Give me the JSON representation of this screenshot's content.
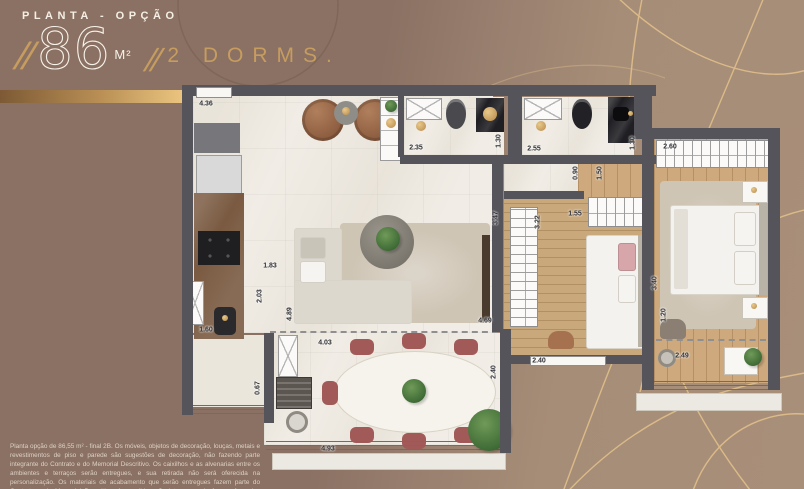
{
  "header": {
    "kicker": "PLANTA - OPÇÃO",
    "slash1": "//",
    "area_value": "86",
    "area_unit": "M²",
    "slash2": "//",
    "dorms": "2 DORMS."
  },
  "disclaimer": "Planta opção de 86,55 m² - final 2B. Os móveis, objetos de decoração, louças, metais e revestimentos de piso e parede são sugestões de decoração, não fazendo parte integrante do Contrato e do Memorial Descritivo. Os caixilhos e as alvenarias entre os ambientes e terraços serão entregues, e sua retirada não será oferecida na personalização. Os materiais de acabamento que serão entregues fazem parte do Contrato e do Memorial Descritivo. As medidas são internas e de face a face das paredes.",
  "plan": {
    "dims": {
      "living_top_width": "4.36",
      "bath1_width": "2.35",
      "bath1_depth": "1.30",
      "bath2_width": "2.55",
      "bath2_depth": "1.30",
      "suite_wardrobe_width": "2.60",
      "hall_width": "0.90",
      "hall_length": "1.50",
      "dorm2_length": "3.47",
      "dorm2_inner_length": "3.22",
      "dorm2_top_width": "1.55",
      "kitchen_passage": "1.83",
      "kitchen_depth": "2.03",
      "living_length": "4.89",
      "kitchen_counter": "1.60",
      "kitchen_terrace_depth": "0.67",
      "living_bottom_width": "4.03",
      "living_right_width": "4.69",
      "terrace_depth": "2.40",
      "terrace_width": "4.93",
      "dorm2_bottom_width": "2.40",
      "suite_length": "3.40",
      "suite_balcony_depth": "1.20",
      "suite_balcony_width": "2.49"
    },
    "fixtures": [
      "fridge",
      "cooktop",
      "kitchen-sink",
      "shower",
      "toilet",
      "washbasin",
      "sofa",
      "coffee-table",
      "rug",
      "armchair",
      "dining-table",
      "dining-chair",
      "grill",
      "round-sink",
      "plant",
      "wardrobe",
      "bed",
      "nightstand",
      "sliding-door",
      "window",
      "railing"
    ]
  },
  "colors": {
    "accent_gold": "#C69C5F",
    "background_left": "#8A7163",
    "background_right": "#A68D77",
    "wall": "#55545A",
    "marble_floor": "#F1EDE6",
    "wood_floor": "#CDA97D",
    "chair_maroon": "#A15A58",
    "text_cream": "#F5EFE5"
  }
}
